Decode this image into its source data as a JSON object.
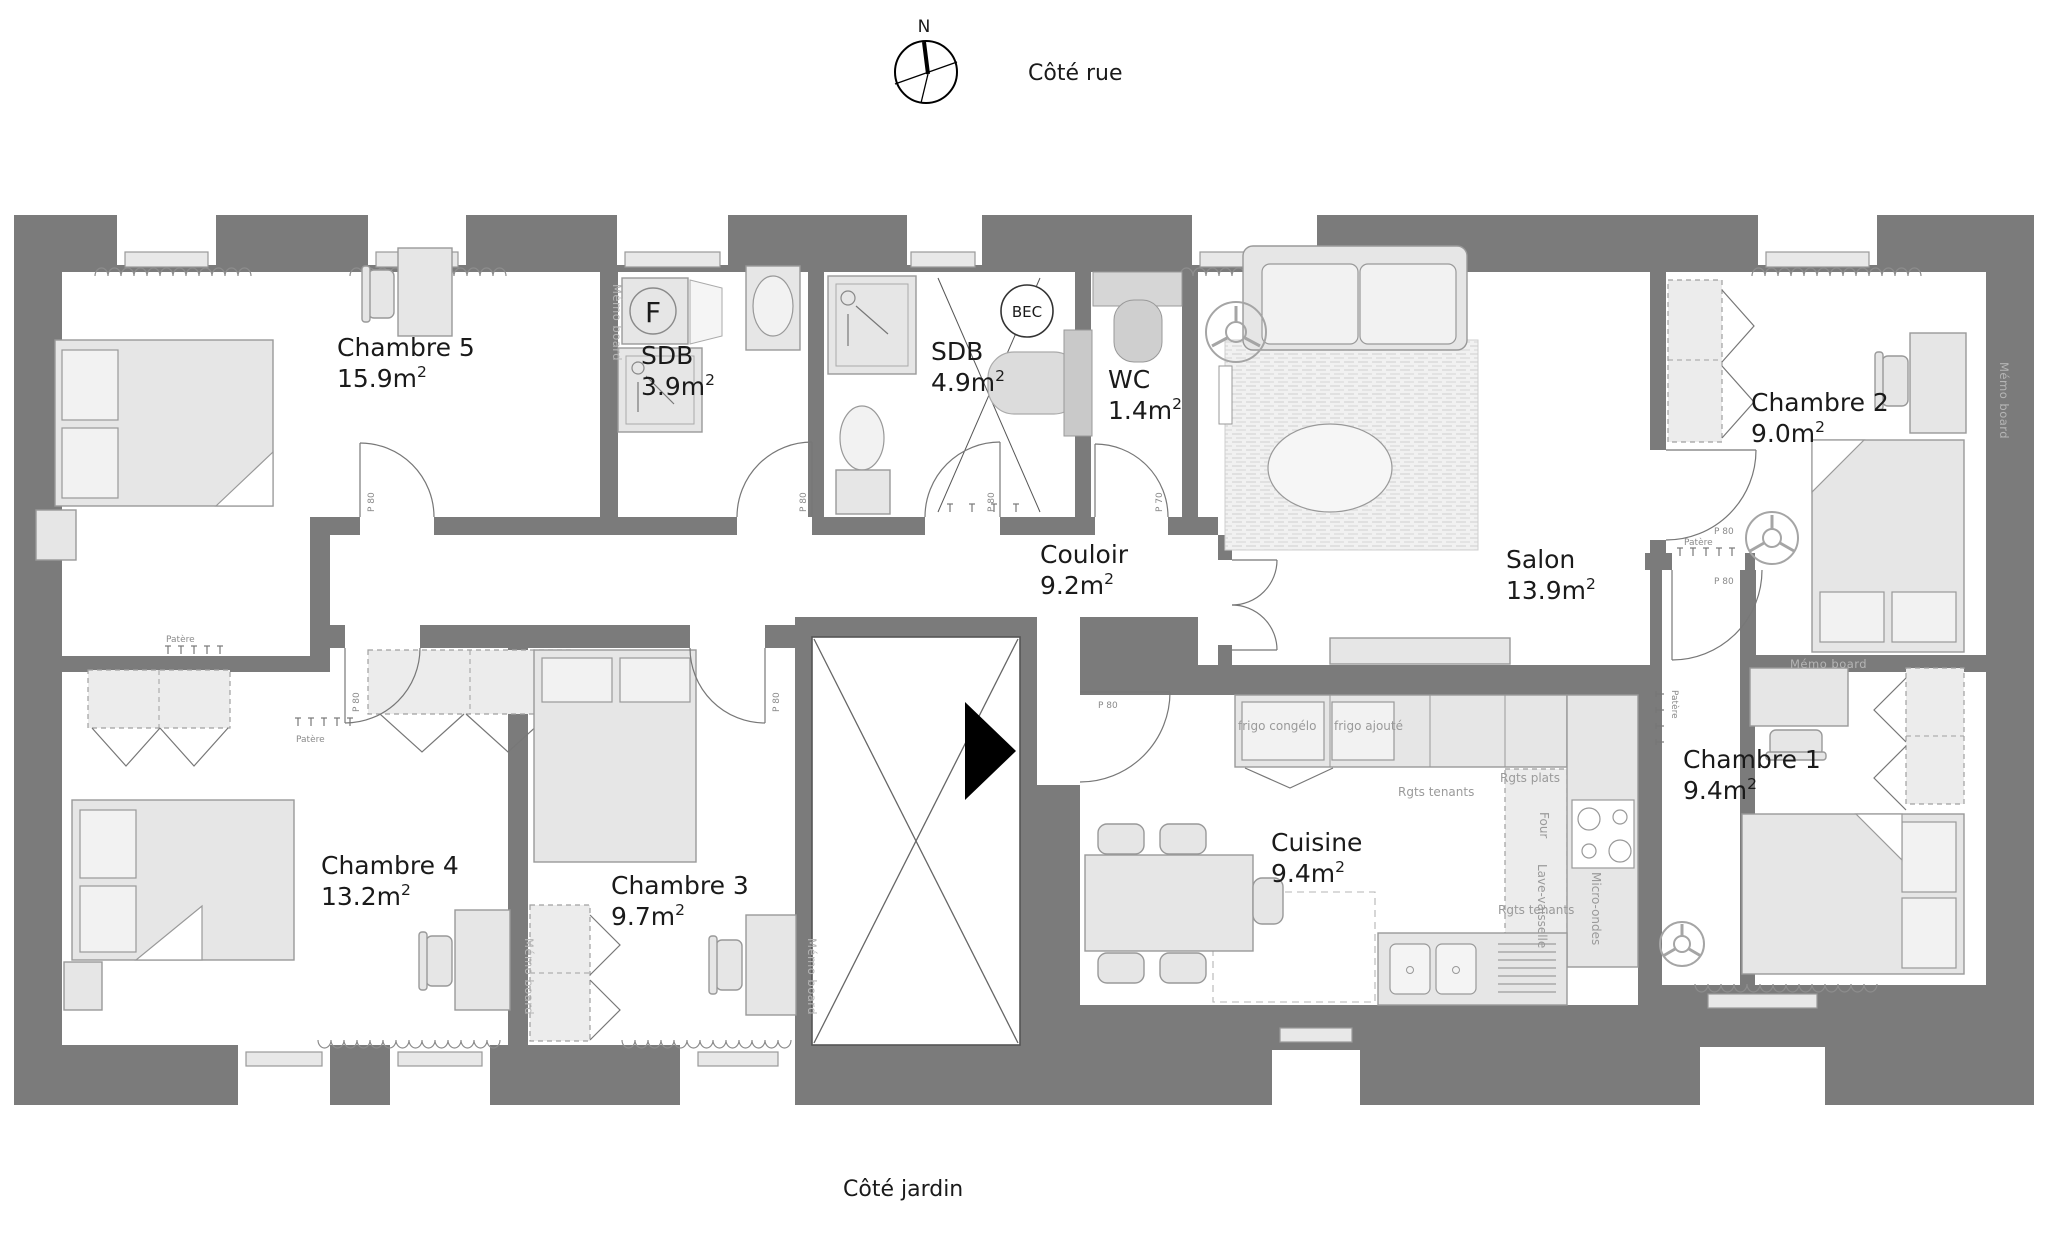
{
  "captions": {
    "north": "N",
    "street_side": "Côté rue",
    "garden_side": "Côté jardin"
  },
  "rooms": [
    {
      "id": "chambre5",
      "name": "Chambre 5",
      "area": "15.9m2"
    },
    {
      "id": "sdb1",
      "name": "SDB",
      "area": "3.9m2"
    },
    {
      "id": "sdb2",
      "name": "SDB",
      "area": "4.9m2"
    },
    {
      "id": "wc",
      "name": "WC",
      "area": "1.4m2"
    },
    {
      "id": "couloir",
      "name": "Couloir",
      "area": "9.2m2"
    },
    {
      "id": "salon",
      "name": "Salon",
      "area": "13.9m2"
    },
    {
      "id": "chambre2",
      "name": "Chambre 2",
      "area": "9.0m2"
    },
    {
      "id": "chambre1",
      "name": "Chambre 1",
      "area": "9.4m2"
    },
    {
      "id": "chambre4",
      "name": "Chambre 4",
      "area": "13.2m2"
    },
    {
      "id": "chambre3",
      "name": "Chambre 3",
      "area": "9.7m2"
    },
    {
      "id": "cuisine",
      "name": "Cuisine",
      "area": "9.4m2"
    }
  ],
  "doors": {
    "p80": "P 80",
    "p70": "P 70"
  },
  "fixtures": {
    "bec": "BEC",
    "washer_letter": "F",
    "memo_board": "Mémo board",
    "patere": "Patère"
  },
  "kitchen_labels": {
    "fridge_freezer": "frigo congélo",
    "fridge_added": "frigo ajouté",
    "storage_tenants": "Rgts tenants",
    "storage_plates": "Rgts plats",
    "oven": "Four",
    "dishwasher": "Lave-vaisselle",
    "microwave": "Micro-ondes"
  },
  "colors": {
    "wall": "#7b7b7b",
    "furniture_fill": "#e6e6e6",
    "furniture_stroke": "#999999",
    "room_fill": "#ffffff",
    "muted_text": "#9a9a9a",
    "wall_label": "#b5b5b5"
  }
}
